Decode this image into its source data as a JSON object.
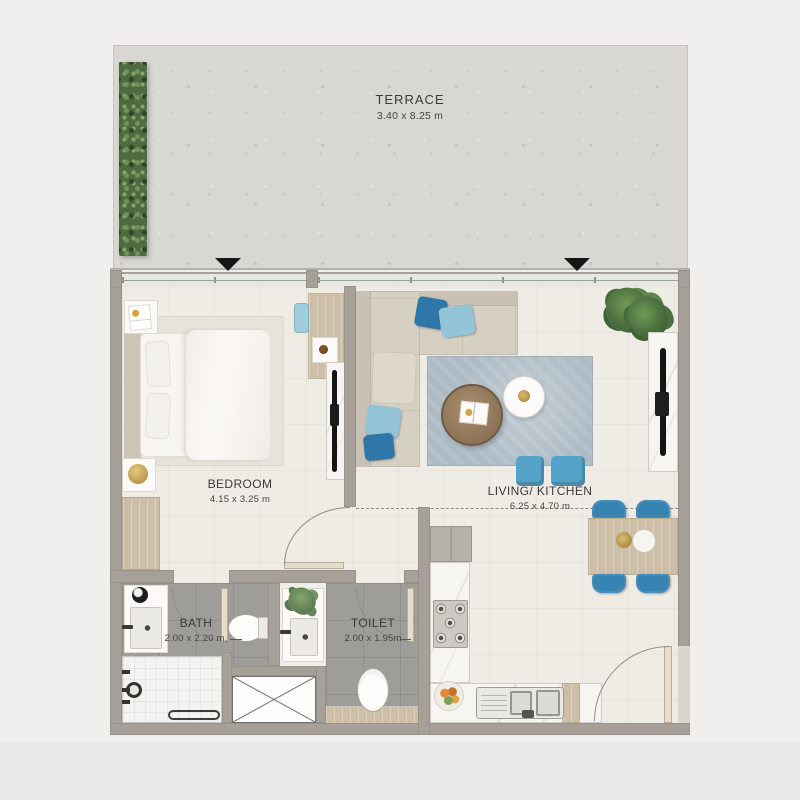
{
  "page": {
    "background": "#f0efed",
    "type": "apartment floor plan"
  },
  "rooms": {
    "terrace": {
      "name": "TERRACE",
      "dims": "3.40 x 8.25 m"
    },
    "bedroom": {
      "name": "BEDROOM",
      "dims": "4.15 x 3.25 m"
    },
    "living_kitchen": {
      "name": "LIVING/ KITCHEN",
      "dims": "6.25 x 4.70 m"
    },
    "bath": {
      "name": "BATH",
      "dims": "2.00 x 2.20 m."
    },
    "toilet": {
      "name": "TOILET",
      "dims": "2.00 x 1.95m"
    }
  },
  "colors": {
    "wall": "#a7a098",
    "terrace_floor": "#d9d7d3",
    "interior_floor": "#efece6",
    "wet_floor": "#9e9d99",
    "accent_blue": "#3784b2",
    "accent_blue_light": "#93c4d8",
    "rug_blue": "#aebbc5",
    "wood": "#cdbfa7",
    "plant_green": "#4f6a40",
    "text": "#3a3a38",
    "entry_marker": "#161616"
  },
  "furniture": [
    "planter-strip",
    "entry-triangle-markers",
    "double-bed",
    "nightstands",
    "wardrobe",
    "bedroom-desk-console",
    "bedroom-tv-panel",
    "l-shaped-sofa",
    "blue-pillows",
    "living-rug",
    "round-coffee-table",
    "round-side-table",
    "blue-poufs",
    "living-tv-panel",
    "potted-plant",
    "dining-table-4-blue-chairs",
    "kitchen-counter-L",
    "gas-hob-5-burner",
    "kitchen-sink",
    "fruit-bowl",
    "bath-vanity",
    "bath-wc",
    "shower",
    "service-shaft",
    "toilet-vanity",
    "toilet-wc"
  ]
}
